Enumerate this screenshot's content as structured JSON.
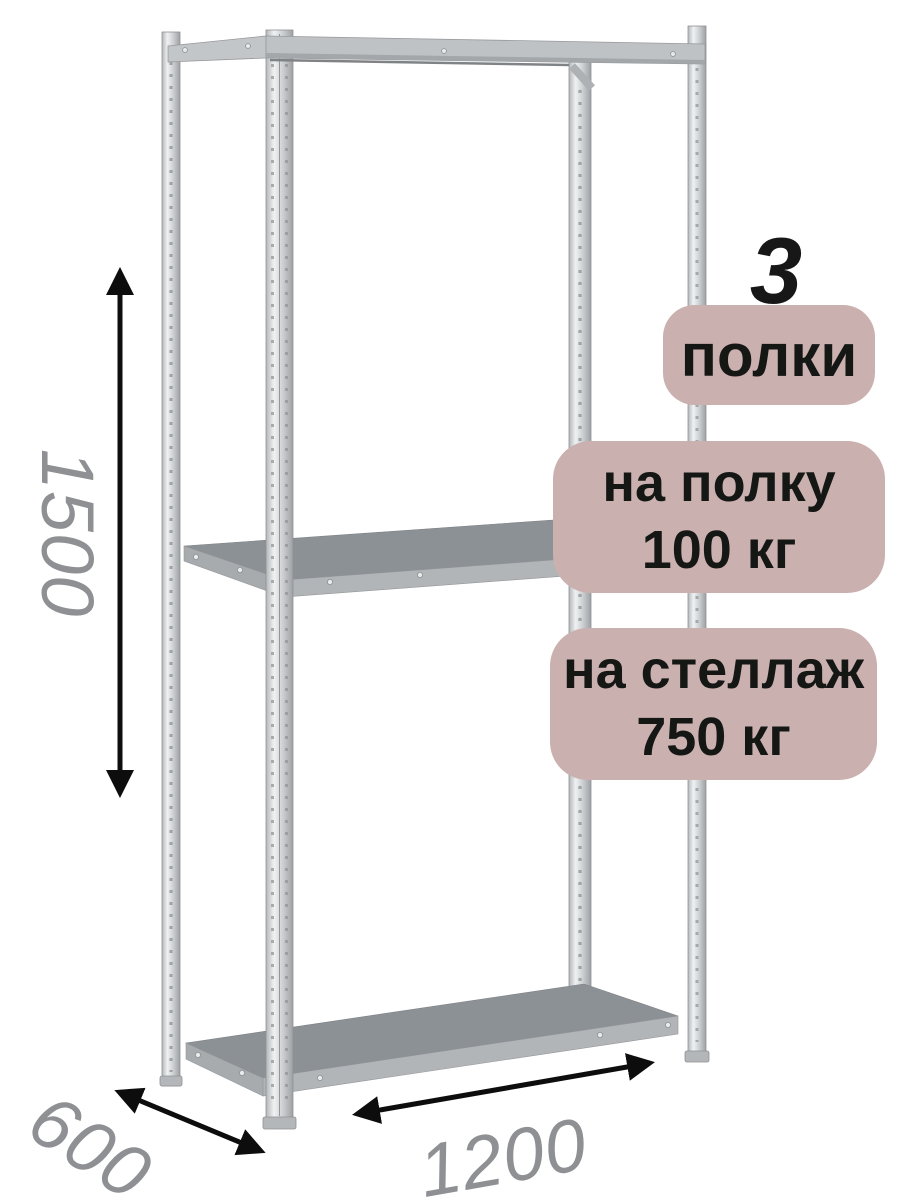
{
  "annotations": {
    "shelf_count": "3",
    "shelf_count_label": "полки",
    "per_shelf_line1": "на полку",
    "per_shelf_line2": "100 кг",
    "per_rack_line1": "на стеллаж",
    "per_rack_line2": "750 кг",
    "dim_height": "1500",
    "dim_depth": "600",
    "dim_width": "1200"
  },
  "colors": {
    "background": "#ffffff",
    "badge_background": "#cab0af",
    "badge_text": "#151715",
    "count_digit": "#171717",
    "dimension_text": "#8e9093",
    "arrow": "#0d0d0d",
    "shelf_surface": "#8c9196",
    "shelf_fascia": "#b2b5b8",
    "metal_light": "#eff1f2",
    "metal_dark": "#9ea1a4"
  },
  "icons": {
    "height_arrow": "double-headed-vertical-arrow",
    "depth_arrow": "double-headed-diagonal-arrow",
    "width_arrow": "double-headed-diagonal-arrow"
  }
}
